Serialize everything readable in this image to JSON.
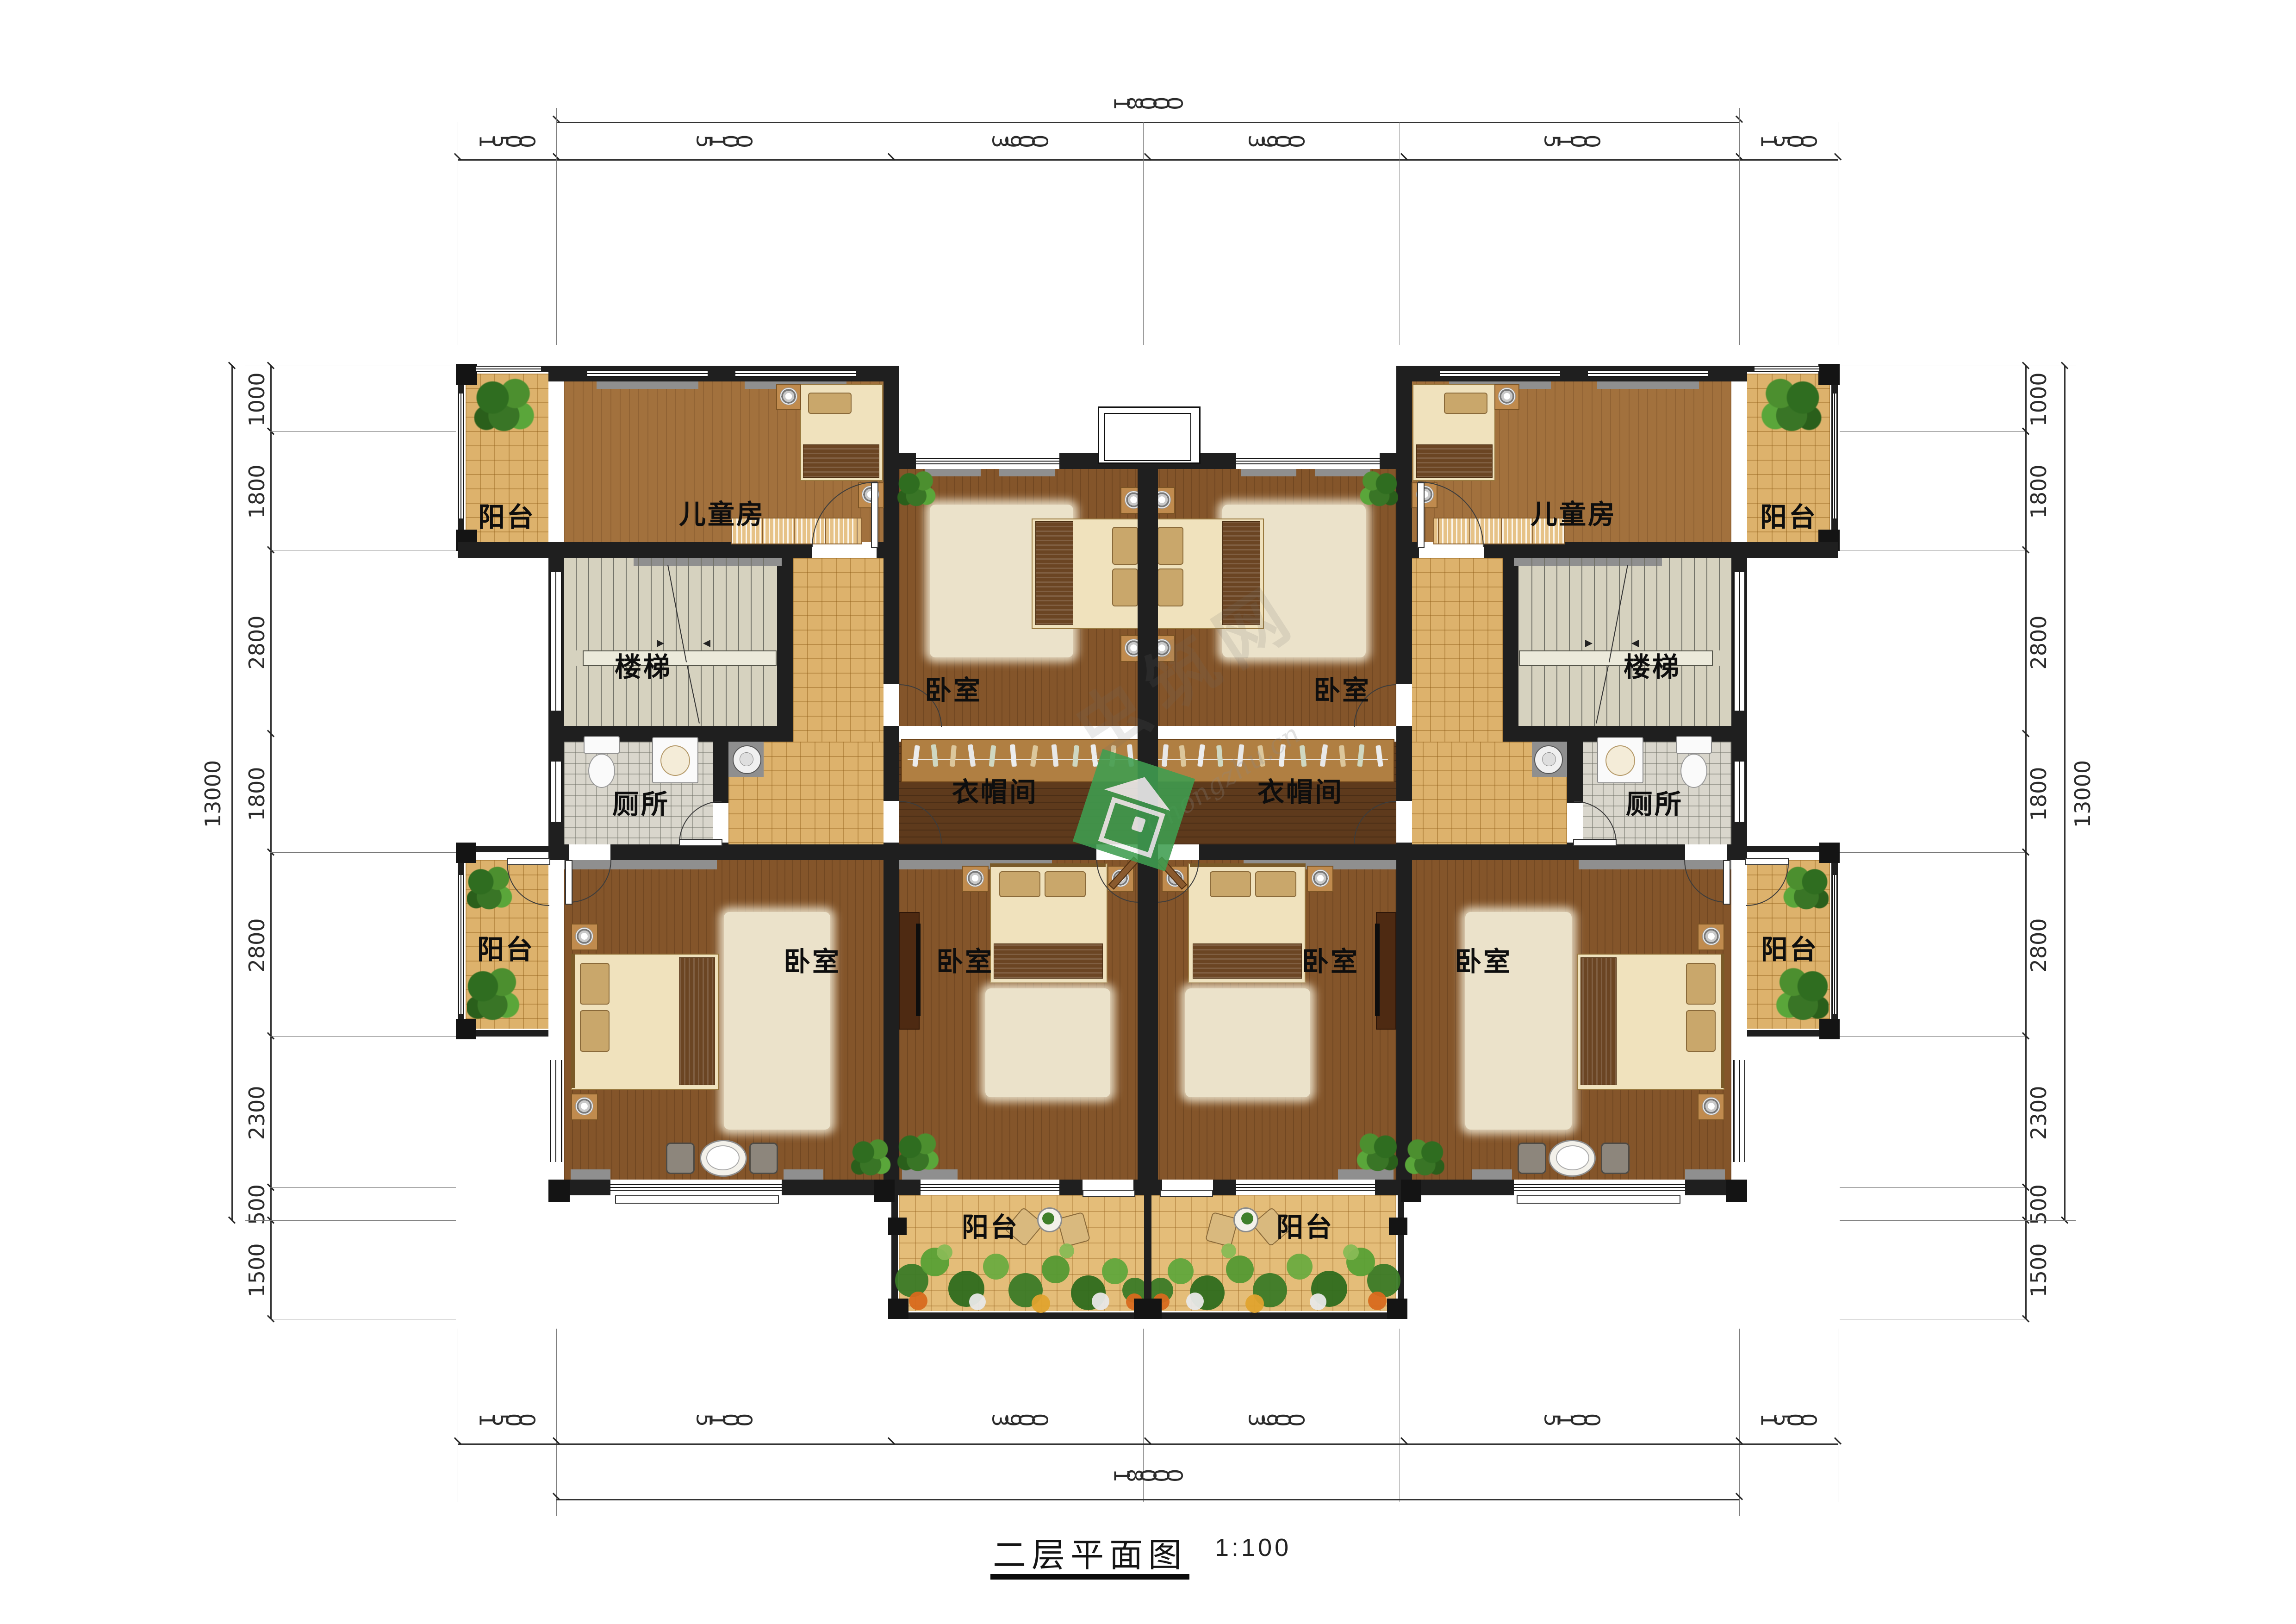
{
  "title": {
    "text": "二层平面图",
    "scale": "1:100"
  },
  "rooms": {
    "balcony": "阳台",
    "children_room": "儿童房",
    "bedroom": "卧室",
    "stairs": "楼梯",
    "toilet": "厕所",
    "cloakroom": "衣帽间"
  },
  "dimensions": {
    "horizontal": {
      "overall": "18000",
      "segments": [
        "1500",
        "5100",
        "3900",
        "3900",
        "5100",
        "1500"
      ]
    },
    "vertical": {
      "overall": "13000",
      "segments": [
        "1000",
        "1800",
        "2800",
        "1800",
        "2800",
        "2300",
        "500",
        "1500"
      ]
    }
  },
  "watermark": {
    "site_latin": "Chongzhu.cn",
    "site_cn": "虫筑网",
    "logo_color": "#3f9e50"
  },
  "colors": {
    "wall": "#1f1f1f",
    "tile_yellow": "#ddb26c",
    "tile_toilet": "#d9d6cc",
    "wood_light": "#a2713d",
    "wood_mid": "#84552a",
    "wood_dark": "#5e3a1c",
    "stairs_floor": "#d6d2bf",
    "dim_text": "#2b2b2b"
  }
}
